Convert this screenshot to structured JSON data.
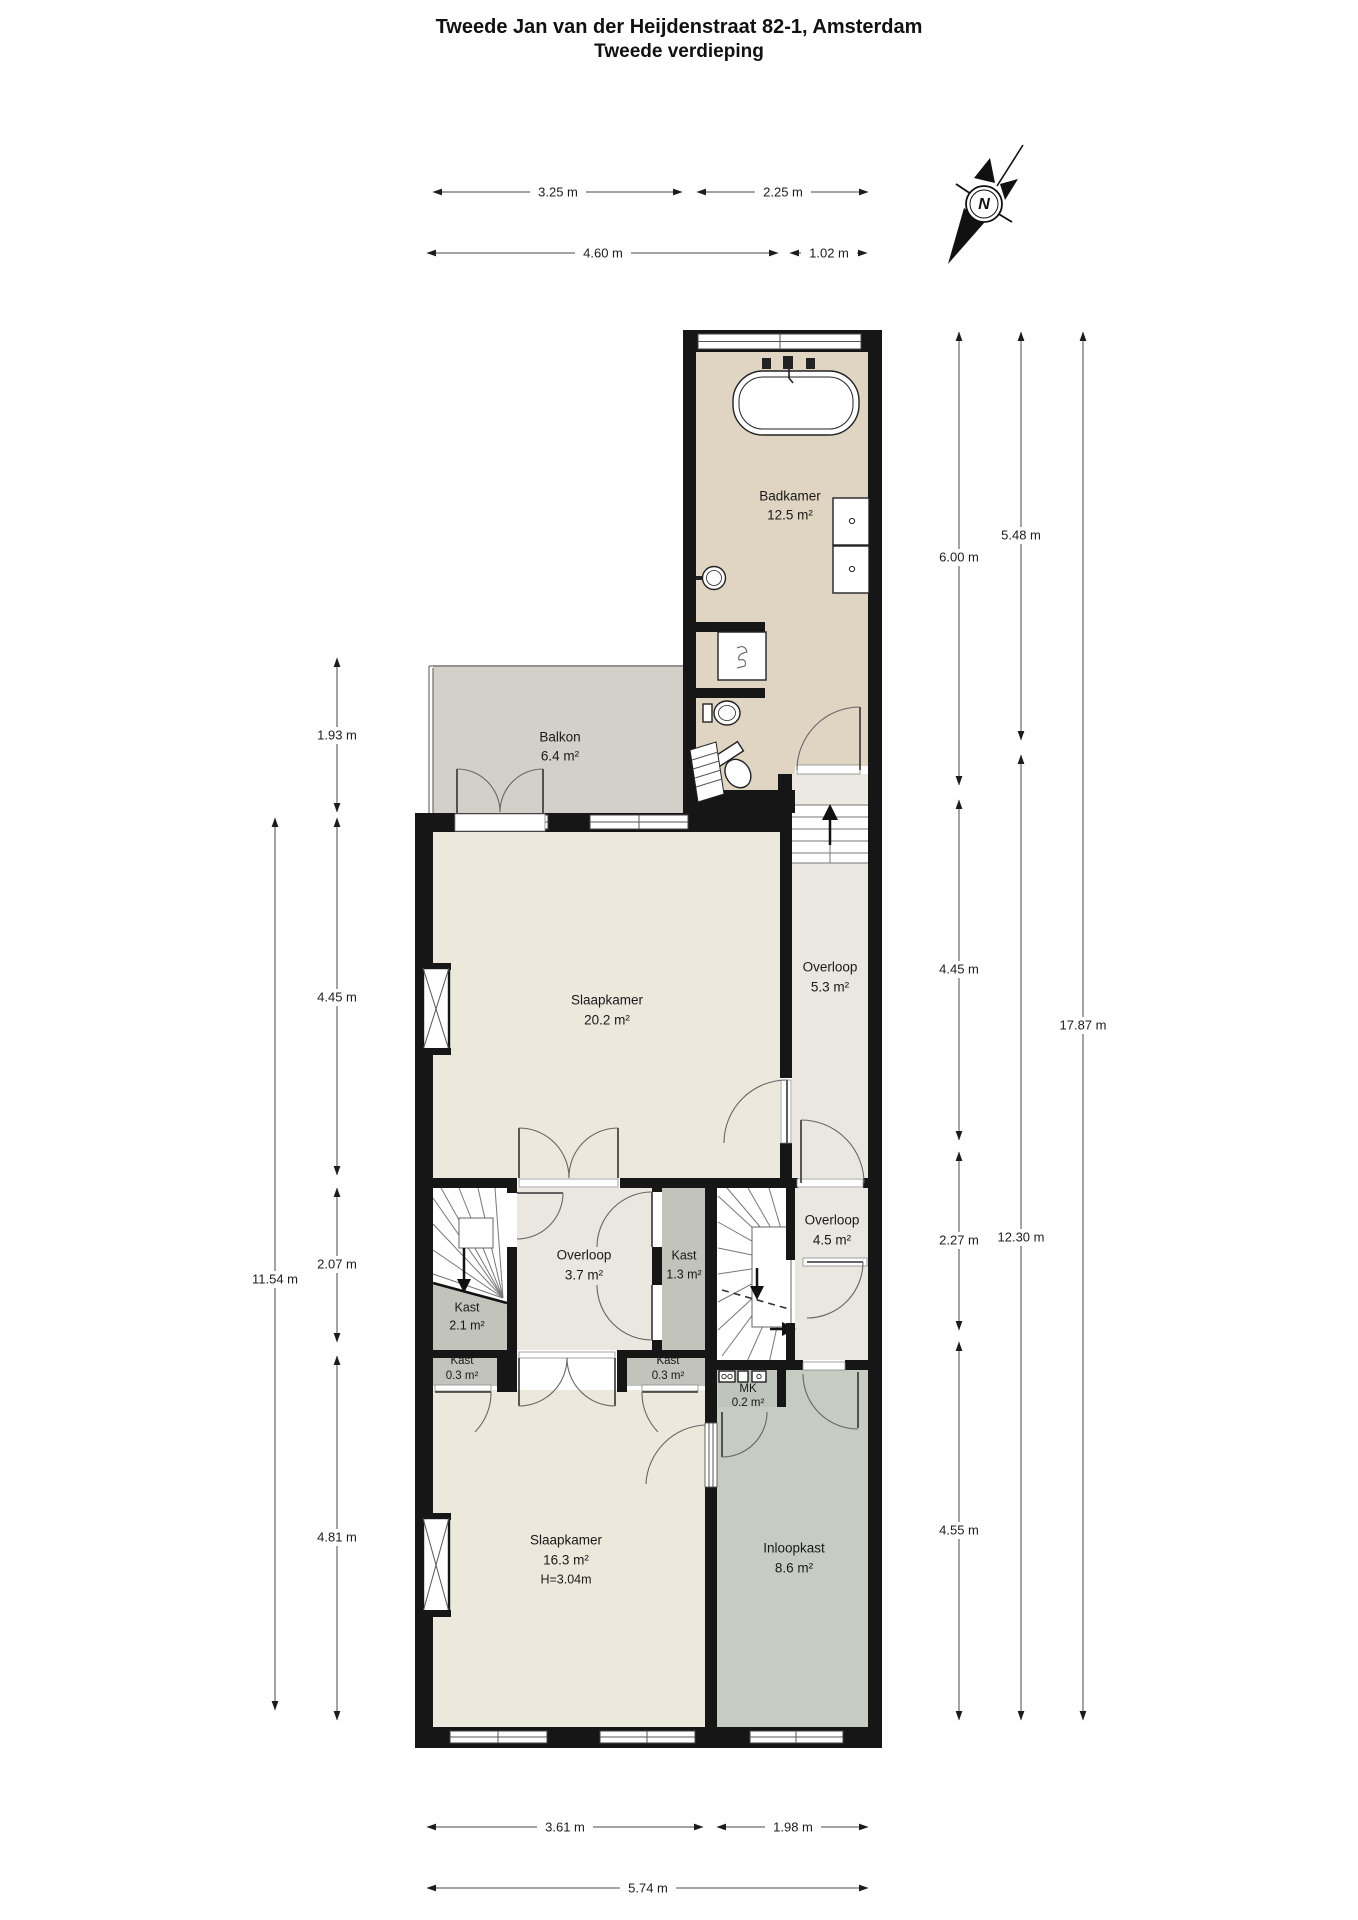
{
  "title": {
    "line1": "Tweede Jan van der Heijdenstraat 82-1, Amsterdam",
    "line2": "Tweede verdieping"
  },
  "compass": {
    "label": "N"
  },
  "rooms": [
    {
      "id": "badkamer",
      "name": "Badkamer",
      "area": "12.5 m²"
    },
    {
      "id": "balkon",
      "name": "Balkon",
      "area": "6.4 m²"
    },
    {
      "id": "slaapkamer-20",
      "name": "Slaapkamer",
      "area": "20.2 m²"
    },
    {
      "id": "overloop-5-3",
      "name": "Overloop",
      "area": "5.3 m²"
    },
    {
      "id": "overloop-3-7",
      "name": "Overloop",
      "area": "3.7 m²"
    },
    {
      "id": "kast-1-3",
      "name": "Kast",
      "area": "1.3 m²"
    },
    {
      "id": "kast-2-1",
      "name": "Kast",
      "area": "2.1 m²"
    },
    {
      "id": "kast-0-3-left",
      "name": "Kast",
      "area": "0.3 m²"
    },
    {
      "id": "kast-0-3-right",
      "name": "Kast",
      "area": "0.3 m²"
    },
    {
      "id": "overloop-4-5",
      "name": "Overloop",
      "area": "4.5 m²"
    },
    {
      "id": "mk",
      "name": "MK",
      "area": "0.2 m²"
    },
    {
      "id": "slaapkamer-16",
      "name": "Slaapkamer",
      "area": "16.3 m²",
      "height": "H=3.04m"
    },
    {
      "id": "inloopkast",
      "name": "Inloopkast",
      "area": "8.6 m²"
    }
  ],
  "dimensions": {
    "top_row1": [
      {
        "label": "3.25 m"
      },
      {
        "label": "2.25 m"
      }
    ],
    "top_row2": [
      {
        "label": "4.60 m"
      },
      {
        "label": "1.02 m"
      }
    ],
    "left": [
      {
        "label": "1.93 m"
      },
      {
        "label": "4.45 m"
      },
      {
        "label": "2.07 m"
      },
      {
        "label": "4.81 m"
      },
      {
        "label": "11.54 m"
      }
    ],
    "right": [
      {
        "label": "6.00 m"
      },
      {
        "label": "4.45 m"
      },
      {
        "label": "2.27 m"
      },
      {
        "label": "4.55 m"
      },
      {
        "label": "5.48 m"
      },
      {
        "label": "12.30 m"
      },
      {
        "label": "17.87 m"
      }
    ],
    "bottom": [
      {
        "label": "3.61 m"
      },
      {
        "label": "1.98 m"
      },
      {
        "label": "5.74 m"
      }
    ]
  },
  "colors": {
    "wall": "#161616",
    "badkamer": "#e0d5c3",
    "balkon": "#d2d0c8",
    "slaapkamer": "#ece8dc",
    "overloop": "#e9e7df",
    "kast": "#c2c3bb",
    "inloopkast": "#c7ccc2",
    "mk": "#bfc5bc",
    "landing": "#ebe9e1",
    "dimension_line": "#4a4a4a"
  }
}
